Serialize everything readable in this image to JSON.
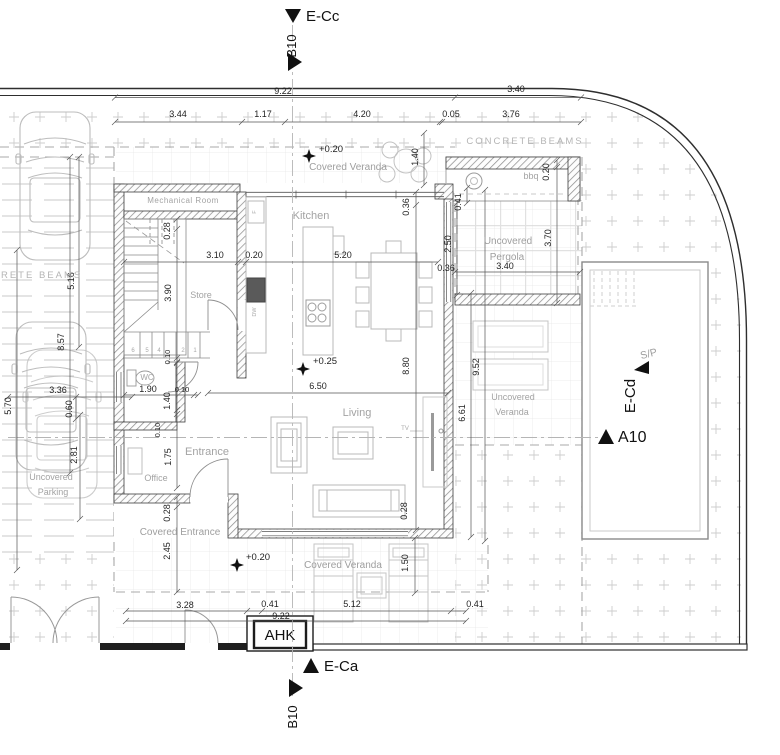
{
  "markers": {
    "e_cc": "E-Cc",
    "b10_top": "B10",
    "e_ca": "E-Ca",
    "b10_bottom": "B10",
    "s_p": "S/P",
    "e_cd": "E-Cd",
    "a10": "A10"
  },
  "labels": {
    "concrete_beams_right": "CONCRETE BEAMS",
    "concrete_beams_left": "CONCRETE BEAMS",
    "mechanical_room": "Mechanical Room",
    "kitchen": "Kitchen",
    "store": "Store",
    "wc": "WC",
    "office": "Office",
    "entrance": "Entrance",
    "living": "Living",
    "covered_veranda_top": "Covered Veranda",
    "covered_veranda_bottom": "Covered Veranda",
    "covered_entrance": "Covered Entrance",
    "uncovered_parking_1": "Uncovered",
    "uncovered_parking_2": "Parking",
    "uncovered_pergola_1": "Uncovered",
    "uncovered_pergola_2": "Pergola",
    "uncovered_veranda_1": "Uncovered",
    "uncovered_veranda_2": "Veranda",
    "bbq": "bbq",
    "tv": "TV",
    "ahk": "AHK",
    "dw": "DW",
    "fridge": "F"
  },
  "levels": {
    "veranda_top": "+0.20",
    "living": "+0.25",
    "entrance": "+0.20"
  },
  "dims": {
    "d922_top": "9.22",
    "d340_top": "3.40",
    "d344": "3.44",
    "d117": "1.17",
    "d420": "4.20",
    "d005": "0.05",
    "d376": "3.76",
    "d516": "5.16",
    "d857": "8.57",
    "d336": "3.36",
    "d570": "5.70",
    "d060": "0.60",
    "d281": "2.81",
    "d028_stair": "0.28",
    "d310": "3.10",
    "d020_wall": "0.20",
    "d520": "5.20",
    "d036_ne": "0.36",
    "d140_ver": "1.40",
    "d020_bbq": "0.20",
    "d041_pe": "0.41",
    "d250_pe": "2.50",
    "d036_pe": "0.36",
    "d340_pe": "3.40",
    "d370_pe": "3.70",
    "d390": "3.90",
    "d952": "9.52",
    "d661": "6.61",
    "d650": "6.50",
    "d880": "8.80",
    "d190_wc": "1.90",
    "d010_a": "0.10",
    "d010_b": "0.10",
    "d140_wc": "1.40",
    "d010_c": "0.10",
    "d175": "1.75",
    "d028_lv": "0.28",
    "d028_ce": "0.28",
    "d245": "2.45",
    "d150_bv": "1.50",
    "d328": "3.28",
    "d041_b1": "0.41",
    "d512": "5.12",
    "d041_b2": "0.41",
    "d922_bottom": "9.22"
  },
  "stairs": {
    "n1": "1",
    "n2": "2",
    "n4": "4",
    "n5": "5",
    "n6": "6"
  }
}
